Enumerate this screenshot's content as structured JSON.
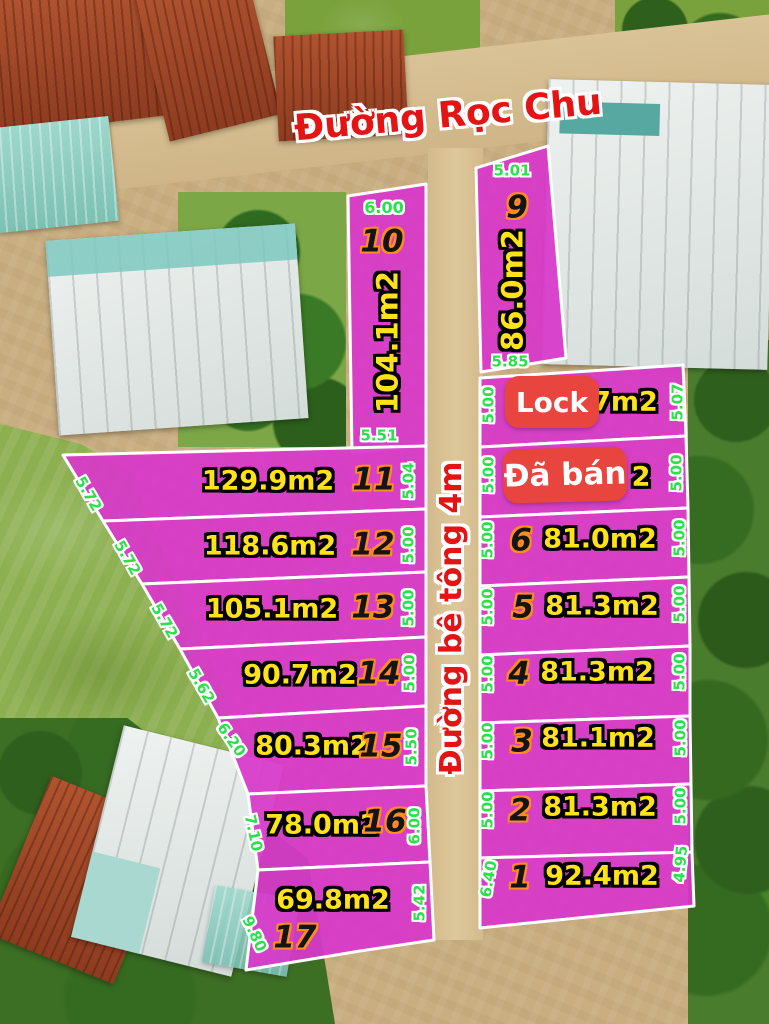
{
  "map": {
    "top_road": "Đường Rọc Chu",
    "center_road": "Đường bê tông 4m"
  },
  "badges": {
    "lock": "Lock",
    "sold": "Đã bán"
  },
  "colors": {
    "plot_fill": "#d838ca",
    "plot_boundary": "#ffffff",
    "area_text": "#ffe318",
    "dim_text": "#27e248",
    "number_text": "#141414",
    "number_outline": "#ff8d1e",
    "road_text": "#e41414",
    "badge_bg": "#e8453e"
  },
  "left_plots": [
    {
      "id": "10",
      "area": "104.1m2",
      "dims": {
        "top": "6.00",
        "bottom": "5.51"
      }
    },
    {
      "id": "11",
      "area": "129.9m2",
      "dims": {
        "left": "5.72",
        "right": "5.04"
      }
    },
    {
      "id": "12",
      "area": "118.6m2",
      "dims": {
        "left": "5.72",
        "right": "5.00"
      }
    },
    {
      "id": "13",
      "area": "105.1m2",
      "dims": {
        "left": "5.72",
        "right": "5.00"
      }
    },
    {
      "id": "14",
      "area": "90.7m2",
      "dims": {
        "left": "5.62",
        "right": "5.00"
      }
    },
    {
      "id": "15",
      "area": "80.3m2",
      "dims": {
        "left": "6.20",
        "right": "5.50"
      }
    },
    {
      "id": "16",
      "area": "78.0m2",
      "dims": {
        "left": "7.10",
        "right": "6.00"
      }
    },
    {
      "id": "17",
      "area": "69.8m2",
      "dims": {
        "left": "9.80",
        "right": "5.42"
      }
    }
  ],
  "right_plots": [
    {
      "id": "9",
      "area": "86.0m2",
      "dims": {
        "top": "5.01",
        "bottom": "5.85"
      }
    },
    {
      "id": "8",
      "area_visible": "7m2",
      "badge": "Lock",
      "dims": {
        "left": "5.00",
        "right": "5.07"
      }
    },
    {
      "id": "7",
      "area_visible": "2",
      "badge": "Đã bán",
      "dims": {
        "left": "5.00",
        "right": "5.00"
      }
    },
    {
      "id": "6",
      "area": "81.0m2",
      "dims": {
        "left": "5.00",
        "right": "5.00"
      }
    },
    {
      "id": "5",
      "area": "81.3m2",
      "dims": {
        "left": "5.00",
        "right": "5.00"
      }
    },
    {
      "id": "4",
      "area": "81.3m2",
      "dims": {
        "left": "5.00",
        "right": "5.00"
      }
    },
    {
      "id": "3",
      "area": "81.1m2",
      "dims": {
        "left": "5.00",
        "right": "5.00"
      }
    },
    {
      "id": "2",
      "area": "81.3m2",
      "dims": {
        "left": "5.00",
        "right": "5.00"
      }
    },
    {
      "id": "1",
      "area": "92.4m2",
      "dims": {
        "left": "6.40",
        "right": "4.95"
      }
    }
  ]
}
